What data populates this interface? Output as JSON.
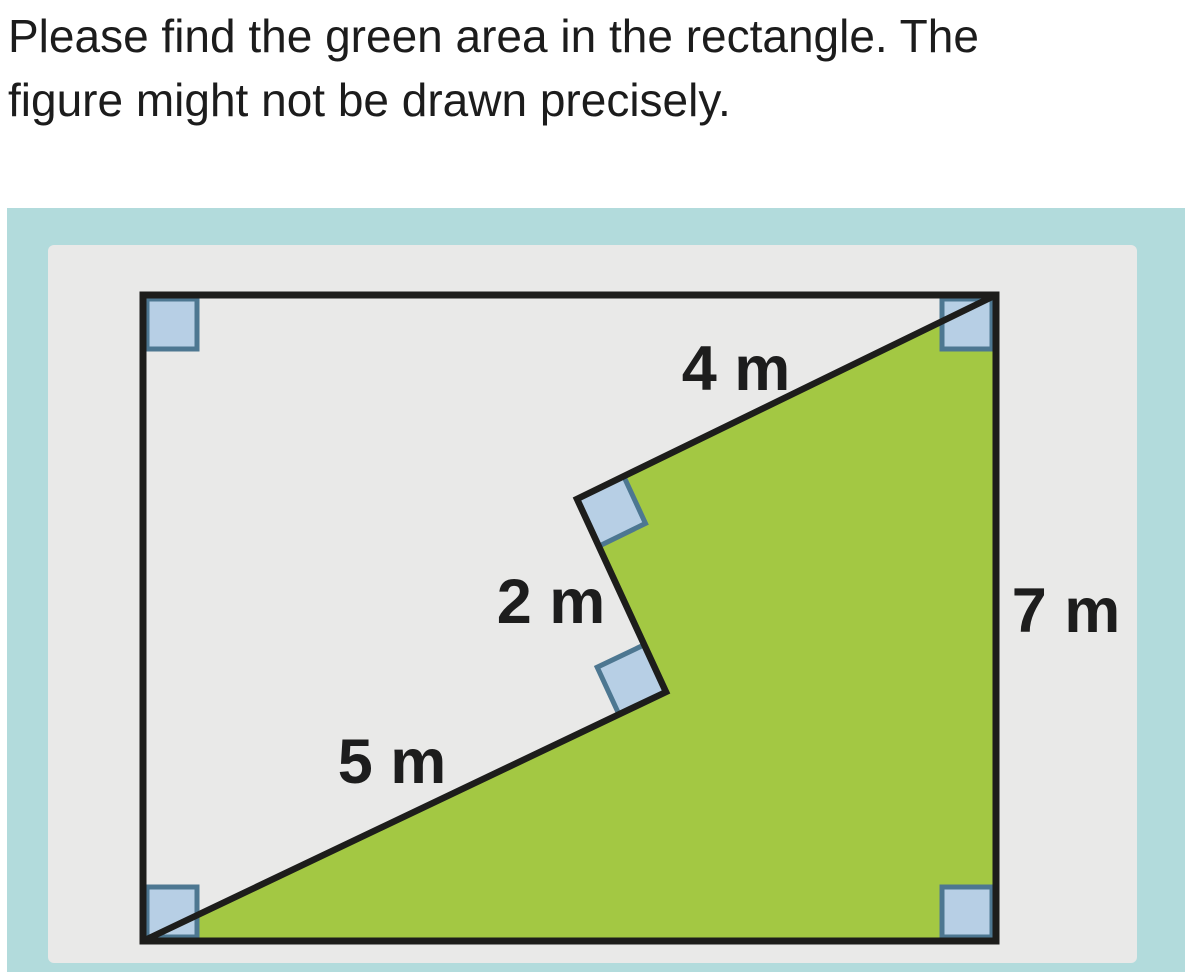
{
  "problem": {
    "line1": "Please find the green area in the rectangle. The",
    "line2": "figure might not be drawn precisely."
  },
  "figure": {
    "measurements": {
      "top_diagonal": "4 m",
      "notch_edge": "2 m",
      "bottom_diagonal": "5 m",
      "right_side": "7 m"
    },
    "colors": {
      "green_region": "#a3c843",
      "frame_teal": "#b2dbdc",
      "panel_gray": "#e9e9e8",
      "marker_fill": "#b7cfe5",
      "marker_border": "#4d7791",
      "outline": "#1d1d1b",
      "text": "#1c1c1c",
      "label_text": "#1d1d1d"
    }
  }
}
